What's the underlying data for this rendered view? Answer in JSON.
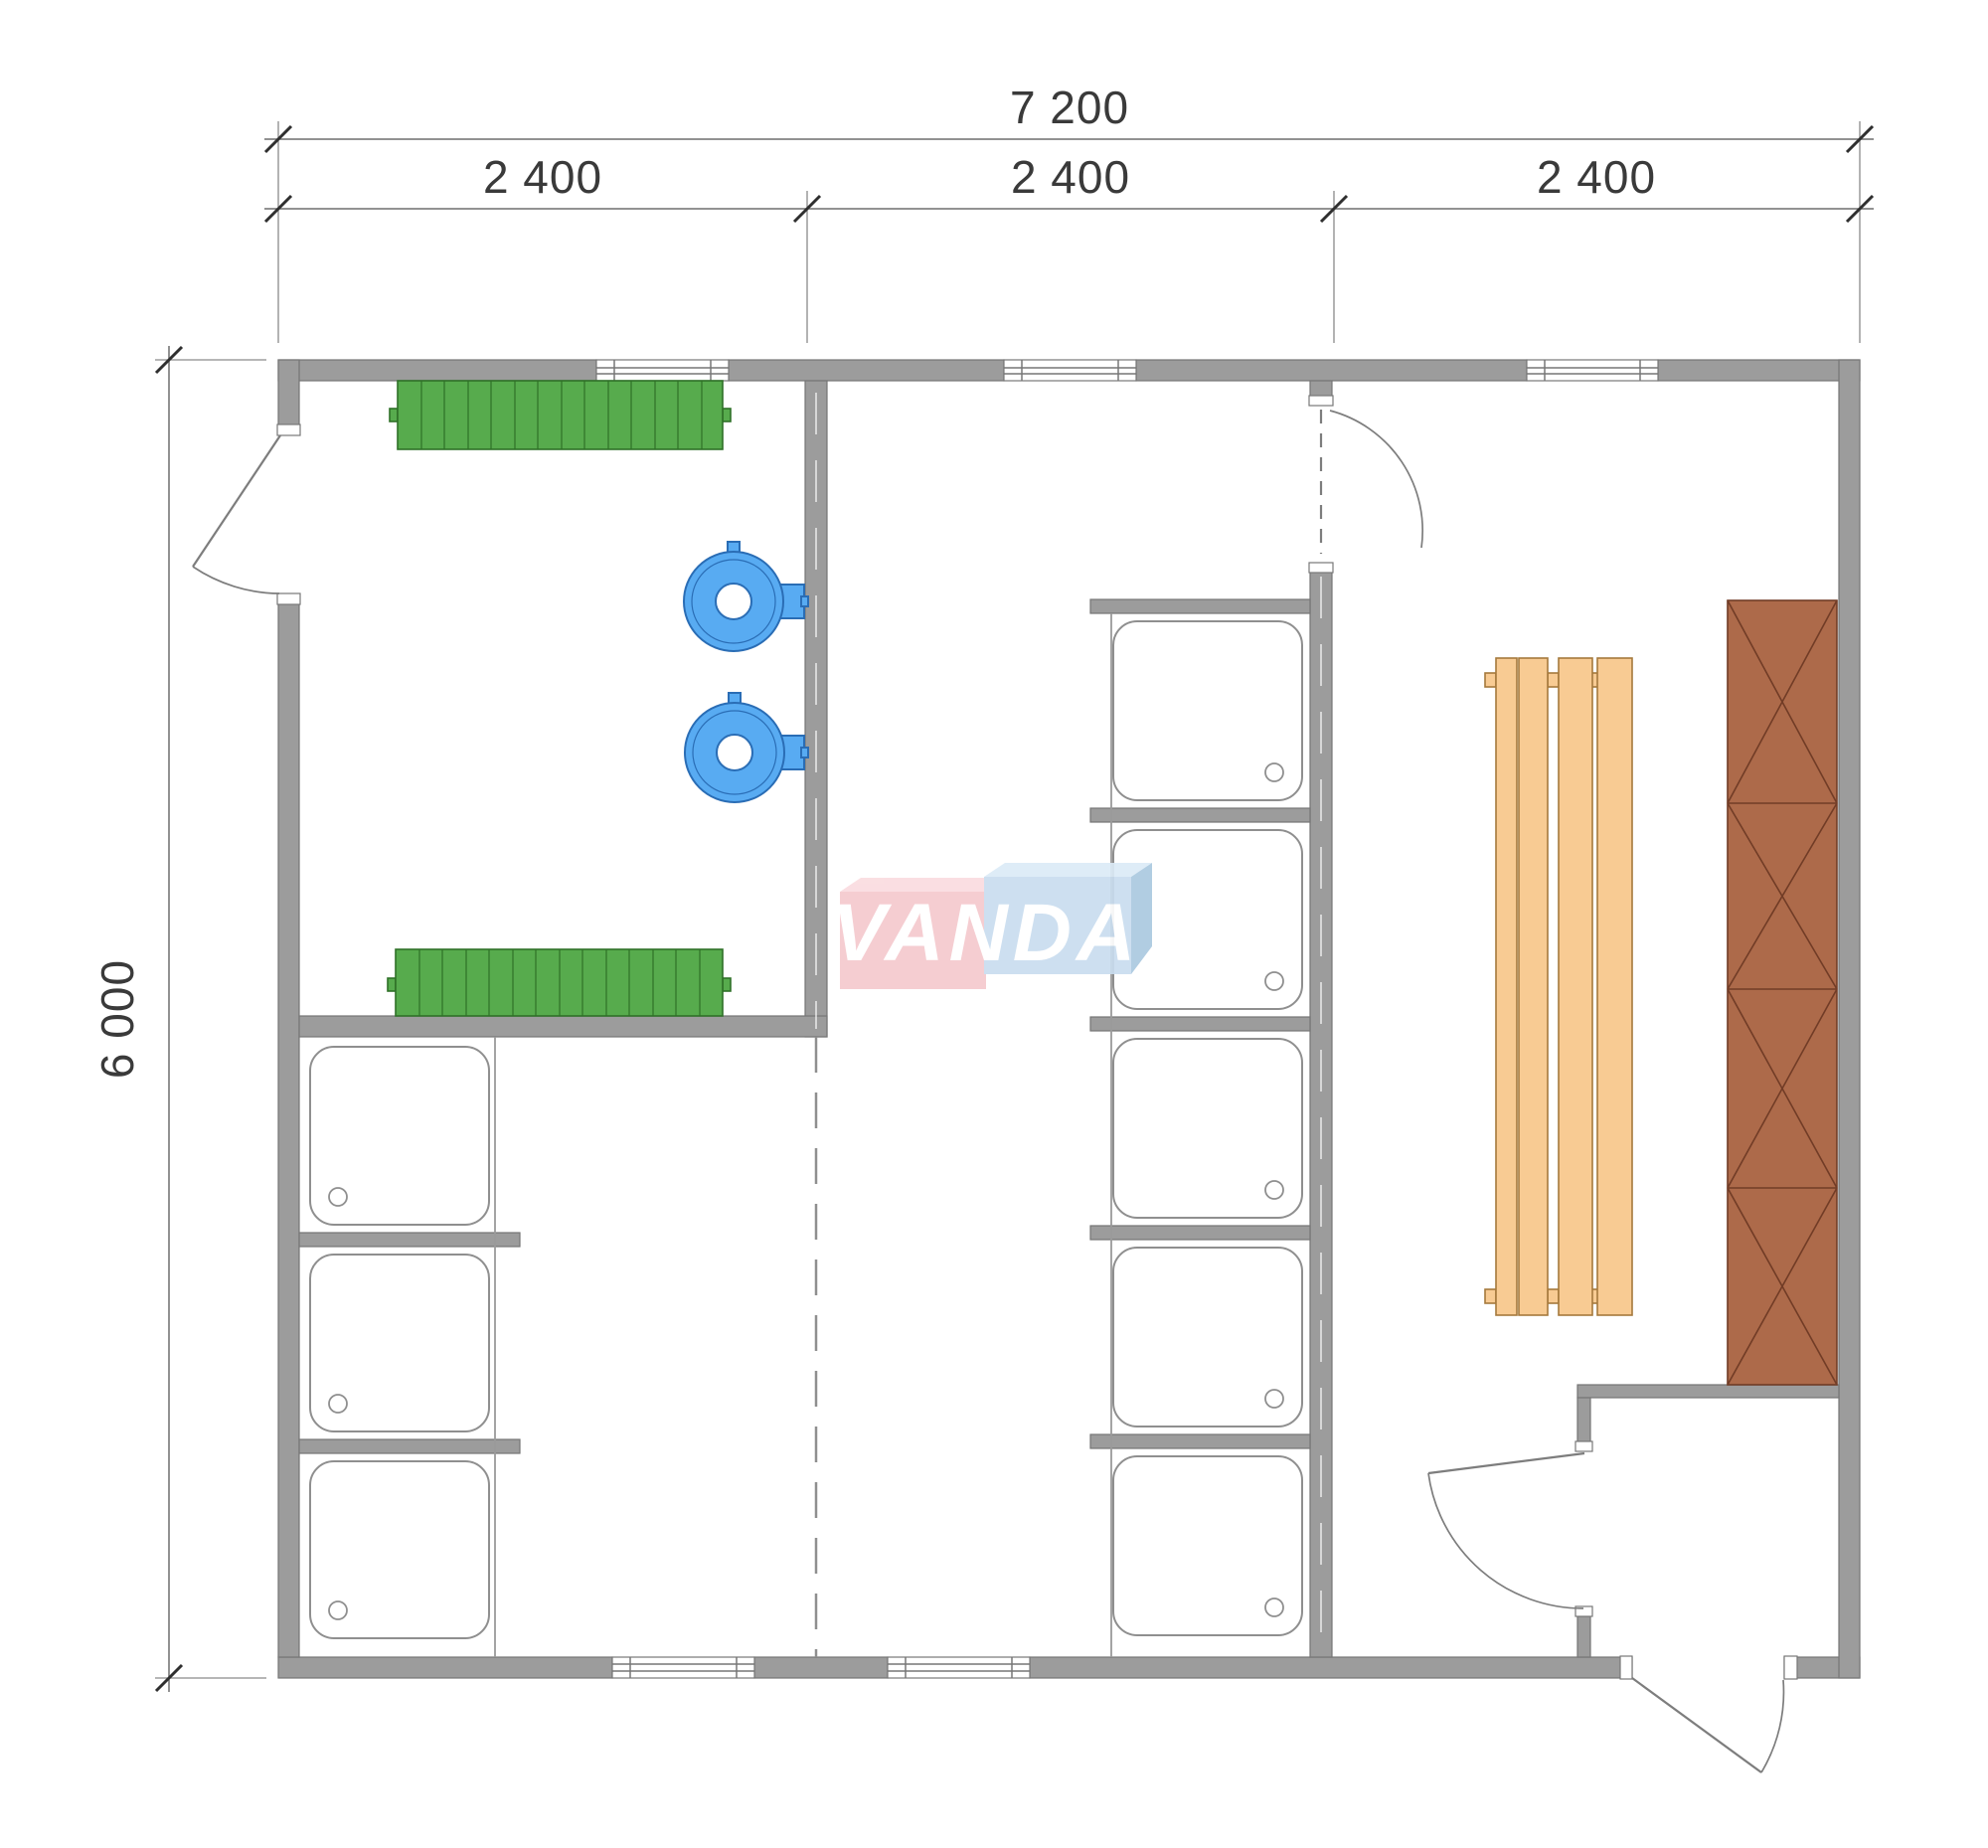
{
  "drawing": {
    "type": "floor-plan",
    "dimensions": {
      "overall_width_mm": "7 200",
      "bay_widths_mm": [
        "2 400",
        "2 400",
        "2 400"
      ],
      "overall_depth_mm": "6 000"
    },
    "watermark": {
      "text": "VANDA"
    },
    "colors": {
      "wall_gray": "#9c9c9c",
      "bench_green": "#57ab4d",
      "washbasin_blue": "#58abf2",
      "sauna_bench_orange": "#f8cb93",
      "stove_brown": "#ad6a4a",
      "watermark_pink": "#f5c9ce",
      "watermark_pink_top": "#fadce0",
      "watermark_blue": "#c9ddef",
      "watermark_blue_top": "#dcebf7",
      "watermark_blue_side": "#abc9e0"
    },
    "fixtures": {
      "coat_benches_green": 2,
      "washbasins_blue": 2,
      "shower_trays_left_room": 3,
      "shower_trays_middle_room": 5,
      "sauna_bench_boards": 4,
      "stove_sections": 4,
      "windows_top_wall": 3,
      "windows_bottom_wall": 2,
      "doors": 4
    }
  }
}
